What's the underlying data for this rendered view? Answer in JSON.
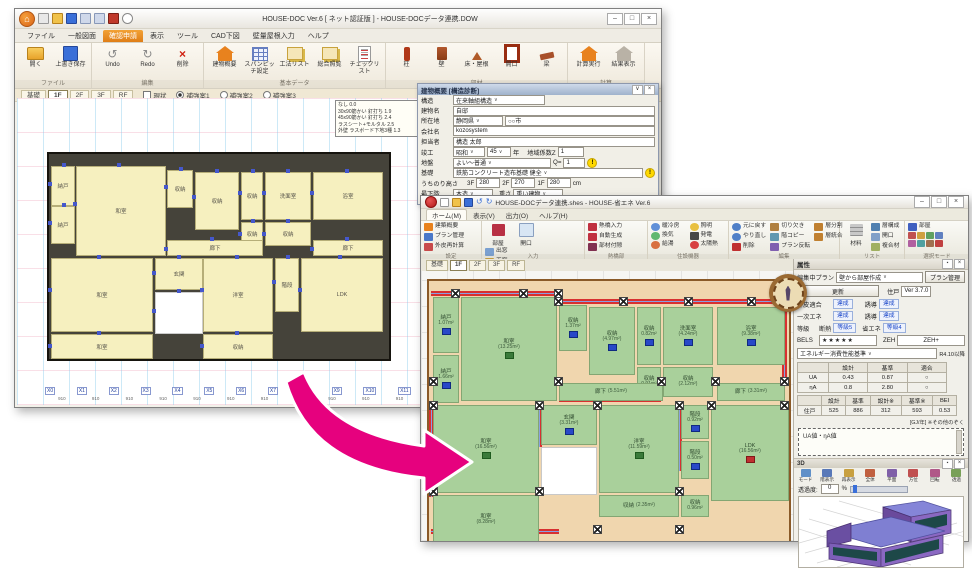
{
  "icons": {
    "house": "⌂",
    "undo": "↺",
    "redo": "↻",
    "delete": "×",
    "dropdown": "∨",
    "warn": "!",
    "min": "–",
    "max": "□",
    "close": "×",
    "pin": "▪",
    "star_note": "※"
  },
  "back_window": {
    "title": "HOUSE-DOC Ver.6 [ ネット認証版 ] - HOUSE-DOCデータ連携.DOW",
    "menu_tabs": [
      "ファイル",
      "一般図面",
      "確認申請",
      "表示",
      "ツール",
      "CAD下図",
      "壁量屋根入力",
      "ヘルプ"
    ],
    "ribbon": {
      "file": {
        "caption": "ファイル",
        "items": [
          "開く",
          "上書き保存"
        ]
      },
      "edit": {
        "caption": "編集",
        "items": [
          "Undo",
          "Redo",
          "削除"
        ]
      },
      "basic": {
        "caption": "基本データ",
        "items": [
          "建物概要",
          "スパンピッチ設定",
          "工法リスト",
          "総合照覧",
          "チェックリスト"
        ]
      },
      "parts": {
        "caption": "部材",
        "items": [
          "柱",
          "壁",
          "床・屋根",
          "開口",
          "梁"
        ]
      },
      "calc": {
        "caption": "計算",
        "items": [
          "計算実行",
          "結果表示"
        ]
      }
    },
    "floor_tabs": [
      "基礎",
      "1F",
      "2F",
      "3F",
      "RF"
    ],
    "view_opts": [
      "現状",
      "補強案1",
      "補強案2",
      "補強案3"
    ],
    "legend": [
      "なし 0.0",
      "30x90筋かい 釘打ち 1.9",
      "45x90筋かい 釘打ち 2.4",
      "ラスシート+モルタル 2.5",
      "外壁 ラスボード下地3種 1.3"
    ],
    "rooms": [
      "納戸",
      "和室",
      "収納",
      "収納",
      "収納",
      "洗面室",
      "浴室",
      "納戸",
      "収納",
      "収納",
      "廊下",
      "廊下",
      "和室",
      "玄関",
      "洋室",
      "階段",
      "LDK",
      "和室",
      "収納"
    ],
    "axis_labels": [
      "X0",
      "X1",
      "X2",
      "X3",
      "X4",
      "X5",
      "X6",
      "X7",
      "X8",
      "X9",
      "X10",
      "X11",
      "X12",
      "X13",
      "X14",
      "X15",
      "X16",
      "X17",
      "X18"
    ],
    "axis_dim": "910",
    "panel": {
      "title": "建物概要 [構造診断]",
      "kozo_label": "構造",
      "kozo": "在来軸組構造",
      "name_label": "建物名",
      "name": "自邸",
      "loc_label": "所在地",
      "pref": "静岡県",
      "city": "○○市",
      "company_label": "会社名",
      "company": "kozosystem",
      "person_label": "担当者",
      "person": "構造 太郎",
      "built_label": "竣工",
      "era": "昭和",
      "year": "45",
      "year_suffix": "年",
      "z_label": "地域係数Z",
      "z": "1",
      "ground_label": "地盤",
      "ground": "よい～普通",
      "q_label": "Q=",
      "q": "1",
      "found_label": "基礎",
      "found": "鉄筋コンクリート造布基礎 健全",
      "height_label": "うちのり高さ",
      "h3f_label": "3F",
      "h3f": "280",
      "h2f_label": "2F",
      "h2f": "270",
      "h1f_label": "1F",
      "h1f": "280",
      "cm": "cm",
      "floor_label": "最下階",
      "floor": "木造",
      "weight_label": "重さ",
      "weight": "重い建物",
      "snow_label": "積雪",
      "snow": "0",
      "m": "m",
      "hbutton": "水平構面の係数..."
    }
  },
  "front_window": {
    "title": "HOUSE-DOCデータ連携.shes - HOUSE-省エネ Ver.6",
    "menu_tabs": [
      "ホーム(M)",
      "表示(V)",
      "出力(O)",
      "ヘルプ(H)"
    ],
    "ribbon": {
      "settings": {
        "caption": "設定",
        "items": [
          "建築概要",
          "プラン管理",
          "外皮再計算"
        ]
      },
      "input": {
        "caption": "入力",
        "items": [
          "部屋",
          "開口",
          "出窓",
          "天窓",
          "床"
        ]
      },
      "thermal": {
        "caption": "熱橋部",
        "items": [
          "熱橋入力",
          "自動生成",
          "部材付隙"
        ]
      },
      "equip": {
        "caption": "住設機器",
        "items": [
          "暖冷房",
          "換気",
          "給湯",
          "照明",
          "発電",
          "太陽熱"
        ]
      },
      "edit": {
        "caption": "編集",
        "items": [
          "元に戻す",
          "やり直し",
          "削除",
          "切り欠き",
          "階コピー",
          "プラン反転",
          "層分割",
          "層統合"
        ]
      },
      "list": {
        "caption": "リスト",
        "items": [
          "材料",
          "層構成",
          "開口",
          "複合材"
        ]
      },
      "select": {
        "caption": "選択モード",
        "items": [
          "部屋"
        ]
      },
      "measure": {
        "caption": "測定",
        "items": [
          "測定"
        ]
      },
      "check": {
        "caption": "チェック",
        "items": [
          "プランチェック",
          "等級判定アシスト"
        ]
      }
    },
    "floor_tabs": [
      "基礎",
      "1F",
      "2F",
      "3F",
      "RF"
    ],
    "rooms": [
      {
        "name": "納戸",
        "area": "1.07m²"
      },
      {
        "name": "和室",
        "area": "(13.25m²)"
      },
      {
        "name": "収納",
        "area": "1.37m²"
      },
      {
        "name": "収納",
        "area": "(4.97m²)"
      },
      {
        "name": "収納",
        "area": "0.82m²"
      },
      {
        "name": "洗面室",
        "area": "(4.24m²)"
      },
      {
        "name": "浴室",
        "area": "(9.38m²)"
      },
      {
        "name": "納戸",
        "area": "1.66m²"
      },
      {
        "name": "収納",
        "area": "0.91m²"
      },
      {
        "name": "収納",
        "area": "(2.12m²)"
      },
      {
        "name": "廊下",
        "area": "(5.51m²)"
      },
      {
        "name": "廊下",
        "area": "(3.31m²)"
      },
      {
        "name": "和室",
        "area": "(16.56m²)"
      },
      {
        "name": "玄関",
        "area": "(3.31m²)"
      },
      {
        "name": "洋室",
        "area": "(11.59m²)"
      },
      {
        "name": "階段",
        "area": "0.92m²"
      },
      {
        "name": "階段",
        "area": "0.50m²"
      },
      {
        "name": "LDK",
        "area": "(16.56m²)"
      },
      {
        "name": "収納",
        "area": "(2.35m²)"
      },
      {
        "name": "収納",
        "area": "0.96m²"
      },
      {
        "name": "和室",
        "area": "(8.28m²)"
      }
    ],
    "panel": {
      "title": "属性",
      "plan_label": "編集中プラン",
      "plan_value": "壁から部屋作成",
      "plan_btn": "プラン管理",
      "update_btn": "更新",
      "unit_label": "住戸",
      "version": "Ver 3.7.0",
      "gaihi_label": "外皮適合",
      "gaihi": "達成",
      "yudo1_label": "誘導",
      "yudo1": "達成",
      "ichiji_label": "一次エネ",
      "ichiji": "達成",
      "yudo2_label": "誘導",
      "yudo2": "達成",
      "tokyu_label": "等級",
      "dannetsu_label": "断熱",
      "dannetsu": "等級5",
      "shoene_label": "省エネ",
      "shoene": "等級4",
      "bels_label": "BELS",
      "bels": "★★★★★",
      "zeh_label": "ZEH",
      "zeh": "ZEH+",
      "standard": "エネルギー消費性能基準",
      "standard_note": "R4.10以降",
      "t1_headers": [
        "",
        "設計",
        "基準",
        "適合"
      ],
      "t1_rows": [
        [
          "UA",
          "0.43",
          "0.87",
          "○"
        ],
        [
          "ηA",
          "0.8",
          "2.80",
          "○"
        ]
      ],
      "t2_headers": [
        "",
        "設計",
        "基準",
        "設計※",
        "基準※",
        "BEI"
      ],
      "t2_rows": [
        [
          "住戸",
          "525",
          "886",
          "312",
          "593",
          "0.53"
        ]
      ],
      "unit_note": "[GJ/年] ※その他のぞく",
      "marquee": "UA値・ηA値"
    },
    "threed": {
      "title": "3D",
      "tools": [
        "モード",
        "階表示",
        "再表示",
        "全体",
        "平面",
        "方位",
        "回転",
        "透過"
      ],
      "opacity_label": "透過度:",
      "opacity": "0",
      "pct": "%"
    }
  }
}
